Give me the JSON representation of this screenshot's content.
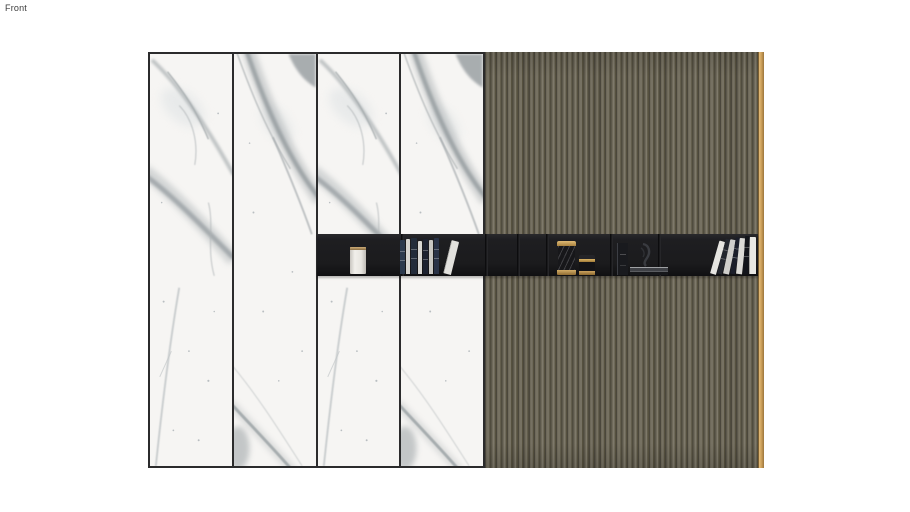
{
  "viewport": {
    "view_label": "Front"
  },
  "wall": {
    "marble_panel_count": 4,
    "wood_slat_count": 50,
    "shelf": {
      "objects": [
        "white-canister",
        "left-book-row",
        "tall-gold-jar",
        "small-gold-jar",
        "standing-book",
        "abstract-sculpture",
        "book-stack",
        "right-leaning-books"
      ]
    }
  },
  "colors": {
    "bg": "#ffffff",
    "marbleBase": "#f6f5f3",
    "panelBorder": "#2b2b2c",
    "woodGroove": "#4b473c",
    "woodDark": "#56513f",
    "woodMid": "#6e695a",
    "woodLight": "#7e796a",
    "gold": "#cfa25c",
    "shelfBg": "#1b1b1d",
    "labelColor": "#3c3c3c"
  }
}
